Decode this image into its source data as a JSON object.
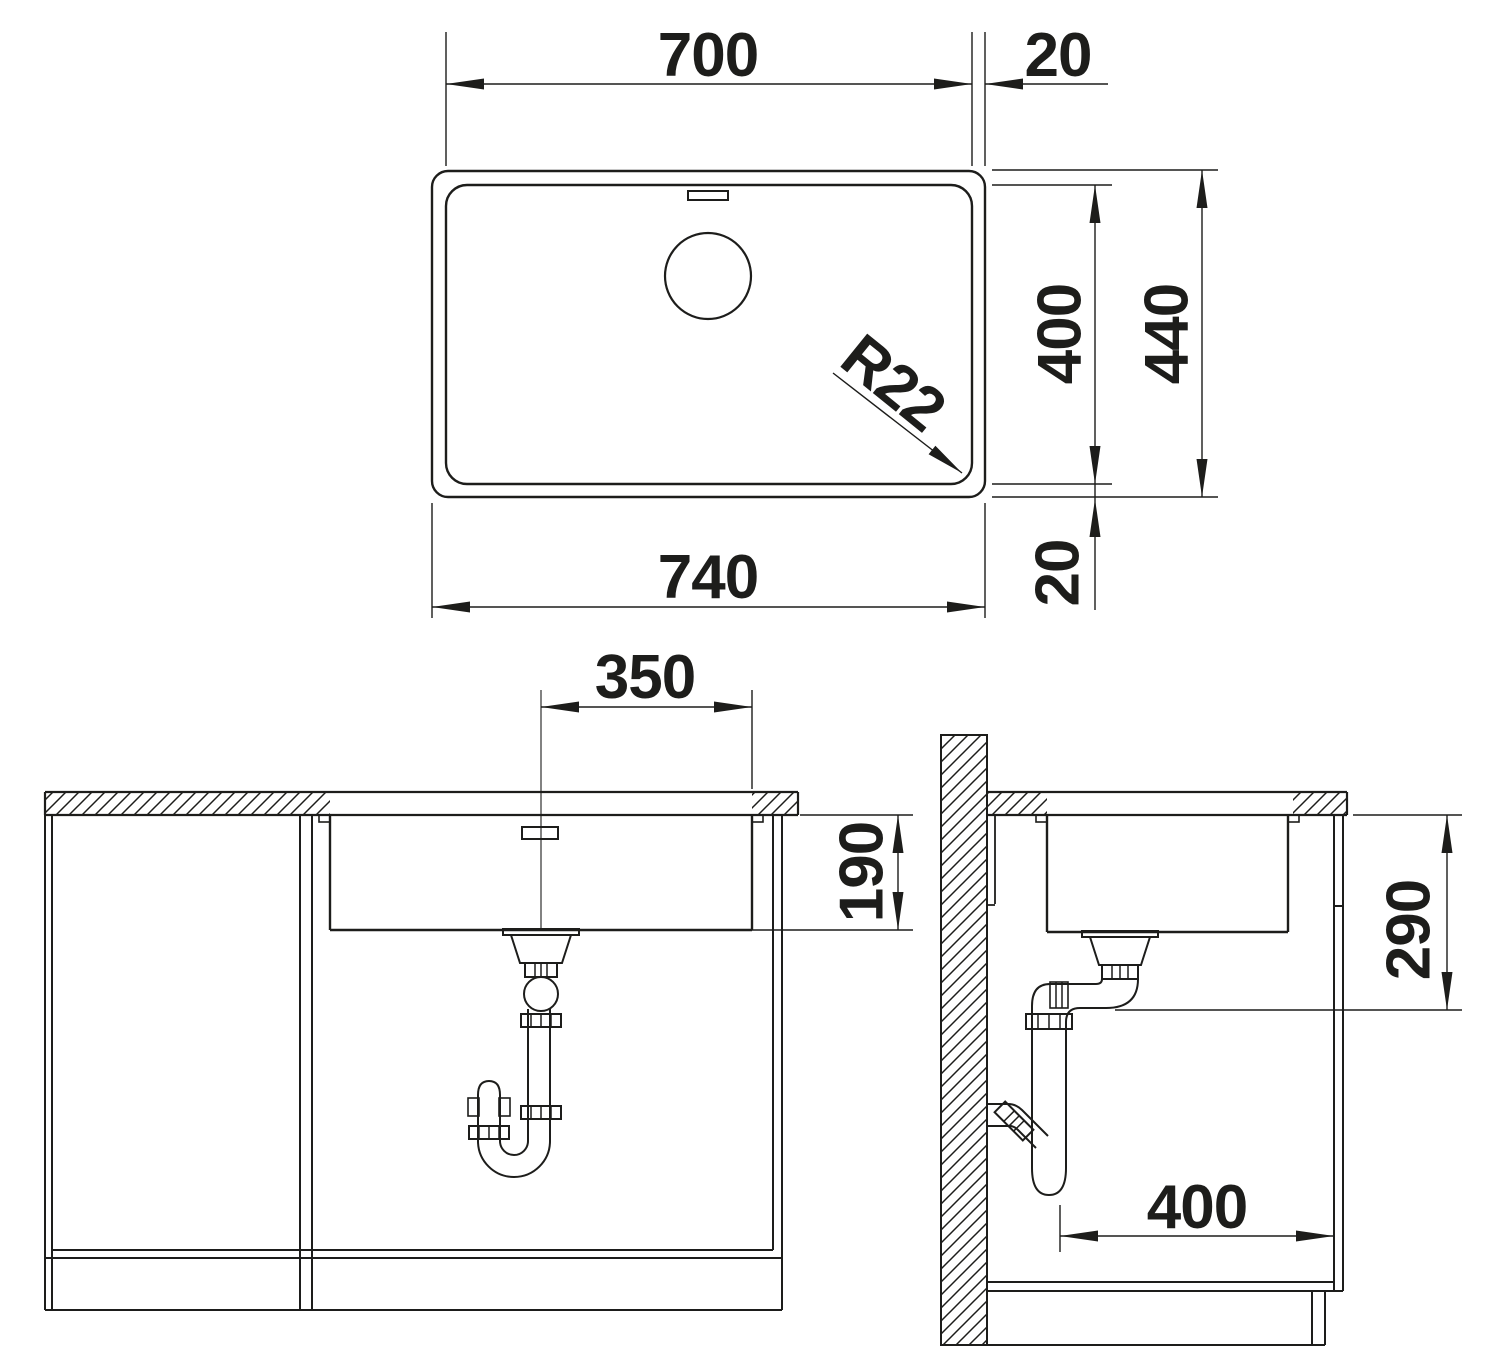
{
  "colors": {
    "line": "#1d1d1b",
    "background": "#ffffff"
  },
  "dimensions": {
    "top_view": {
      "inner_width": "700",
      "rim_right": "20",
      "inner_depth": "400",
      "outer_depth": "440",
      "outer_width": "740",
      "rim_bottom": "20",
      "corner_radius": "R22"
    },
    "front_view": {
      "drain_offset": "350",
      "bowl_depth": "190"
    },
    "side_view": {
      "outlet_height": "290",
      "cabinet_depth": "400"
    }
  }
}
